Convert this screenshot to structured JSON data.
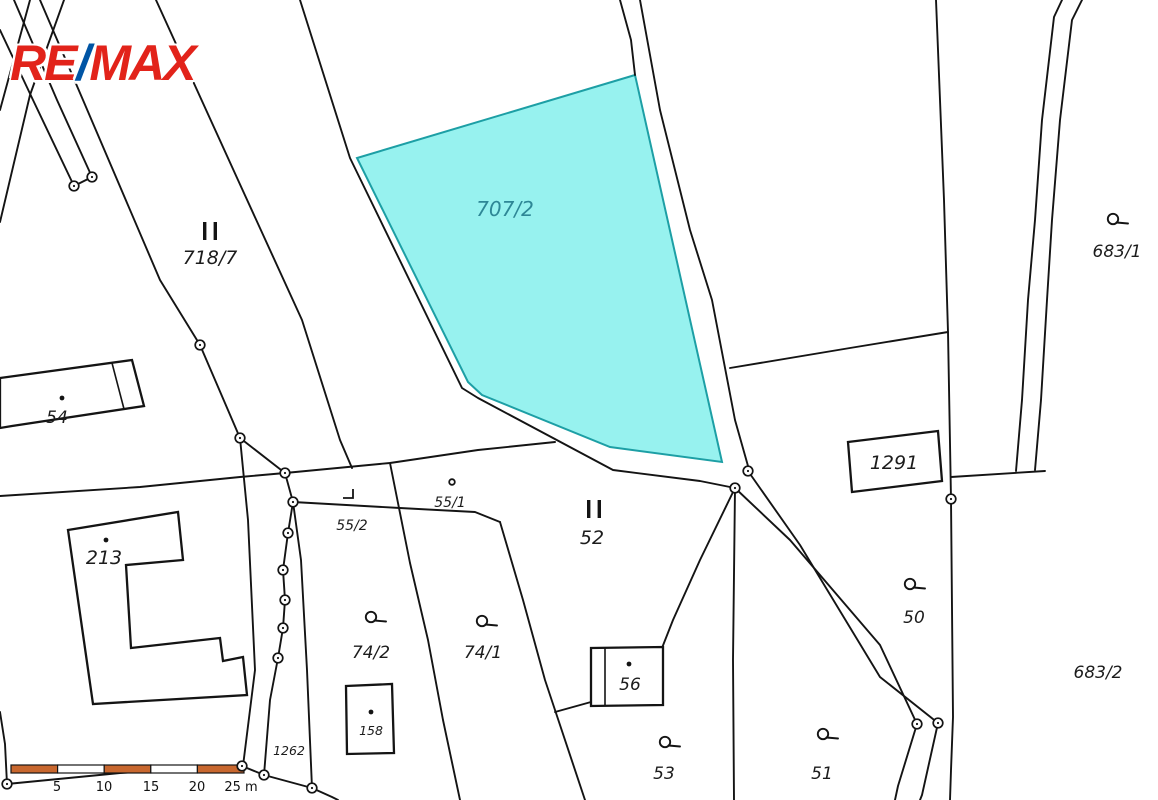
{
  "logo": {
    "re": "RE",
    "slash": "/",
    "max": "MAX"
  },
  "colors": {
    "highlight_fill": "#97F2EF",
    "highlight_stroke": "#1D9FA5",
    "highlight_label_color": "#2E8796",
    "logo_red": "#E2231A",
    "logo_blue": "#0055A5",
    "scalebar_orange": "#C8672E",
    "boundary_line": "#141414"
  },
  "map": {
    "type": "cadastral-parcel-map",
    "highlighted_parcel": "707/2"
  },
  "parcels": [
    {
      "label": "718/7",
      "symbol": "double-bar"
    },
    {
      "label": "707/2",
      "symbol": null,
      "highlighted": true
    },
    {
      "label": "54",
      "symbol": "dot"
    },
    {
      "label": "213",
      "symbol": "dot"
    },
    {
      "label": "55/2",
      "symbol": "corner"
    },
    {
      "label": "55/1",
      "symbol": "point"
    },
    {
      "label": "52",
      "symbol": "double-bar"
    },
    {
      "label": "1291",
      "symbol": null
    },
    {
      "label": "50",
      "symbol": "q"
    },
    {
      "label": "74/2",
      "symbol": "q"
    },
    {
      "label": "74/1",
      "symbol": "q"
    },
    {
      "label": "56",
      "symbol": "dot"
    },
    {
      "label": "158",
      "symbol": "dot"
    },
    {
      "label": "1262",
      "symbol": null
    },
    {
      "label": "53",
      "symbol": "q"
    },
    {
      "label": "51",
      "symbol": "q"
    },
    {
      "label": "683/1",
      "symbol": "q"
    },
    {
      "label": "683/2",
      "symbol": null
    }
  ],
  "scalebar": {
    "ticks": [
      "5",
      "10",
      "15",
      "20",
      "25 m"
    ],
    "segments": 5
  }
}
